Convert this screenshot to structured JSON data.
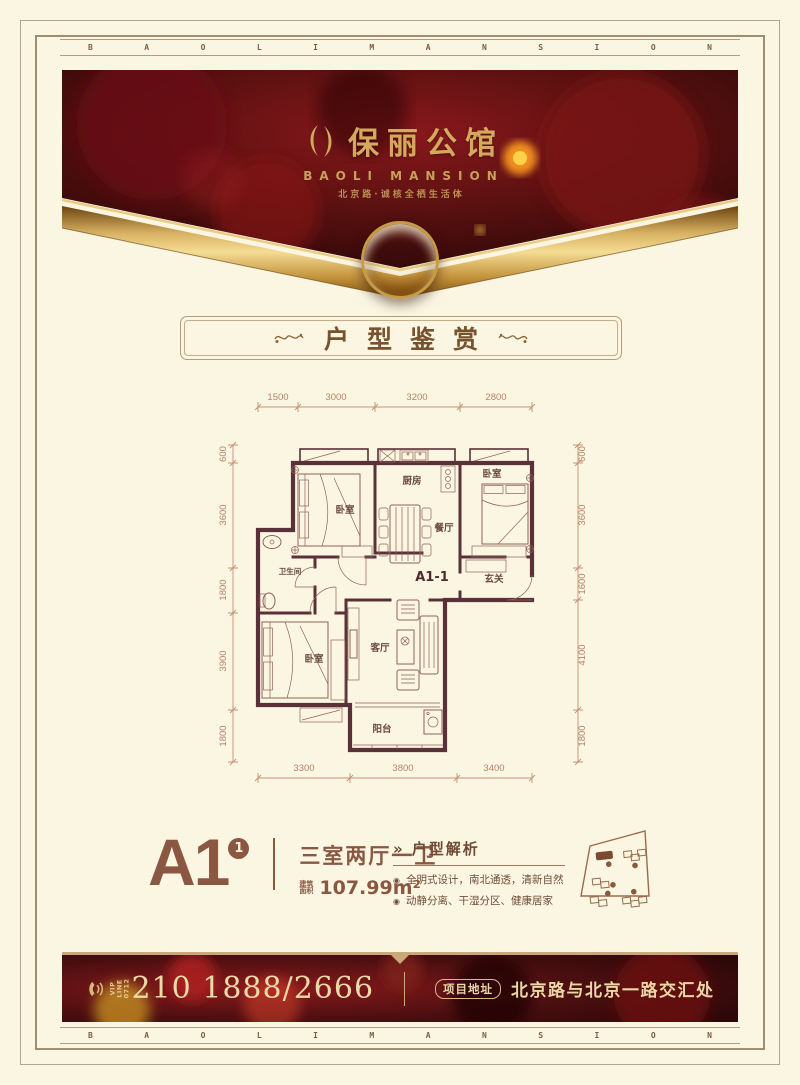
{
  "brand": {
    "letters": [
      "B",
      "A",
      "O",
      "L",
      "I",
      "M",
      "A",
      "N",
      "S",
      "I",
      "O",
      "N"
    ],
    "logo_cn": "保丽公馆",
    "logo_en": "BAOLI MANSION",
    "tagline": "北京路·诚核全栖生活体"
  },
  "section": {
    "title": "户型鉴赏"
  },
  "floorplan": {
    "unit_label": "A1-1",
    "rooms": {
      "bedroom": "卧室",
      "kitchen": "厨房",
      "dining": "餐厅",
      "bath": "卫生间",
      "living": "客厅",
      "balcony": "阳台",
      "entry": "玄关"
    },
    "dims_top": [
      "1500",
      "3000",
      "3200",
      "2800"
    ],
    "dims_bottom": [
      "3300",
      "3800",
      "3400"
    ],
    "dims_left": [
      "600",
      "3600",
      "1800",
      "3900",
      "1800"
    ],
    "dims_right": [
      "600",
      "3600",
      "1600",
      "4100",
      "1800"
    ]
  },
  "unit": {
    "name": "A1",
    "sup": "1",
    "layout": "三室两厅一卫",
    "area_label_1": "建筑",
    "area_label_2": "面积",
    "area": "107.99m²"
  },
  "analysis": {
    "arrow_icon": "»",
    "title": "户型解析",
    "bullet_icon": "◉",
    "bullets": [
      "全明式设计，南北通透，清新自然",
      "动静分离、干湿分区、健康居家"
    ]
  },
  "footer": {
    "vip_line": "VIP LINE",
    "vip_code": "0712",
    "phone": "210 1888/2666",
    "address_label": "项目地址",
    "address": "北京路与北京一路交汇处"
  },
  "colors": {
    "cream": "#fbf6e1",
    "dark_red": "#4a0d10",
    "gold": "#d2a75f",
    "wall": "#5a3138",
    "brown": "#8a5743",
    "dim_line": "#bd8a70"
  }
}
